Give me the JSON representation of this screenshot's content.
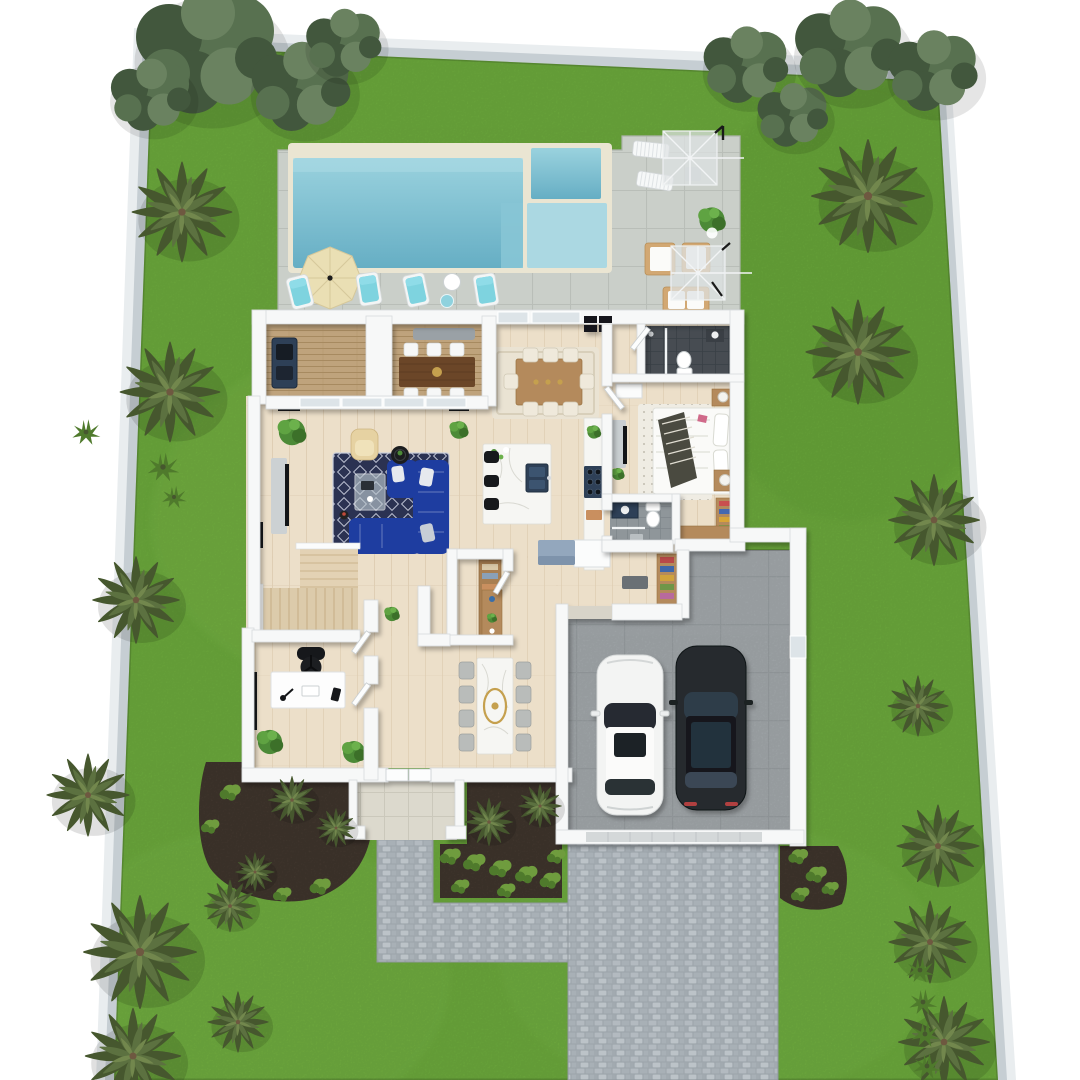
{
  "meta": {
    "title": "3D top-down floor plan rendering of a single-family home lot",
    "view": "aerial orthographic",
    "visible_text": ""
  },
  "colors": {
    "bg": "#ffffff",
    "wallBand": "#c6ced3",
    "wallBandLight": "#e9edef",
    "grass": "#6fae3e",
    "grassLight": "#80bd4e",
    "grassDark": "#5a9931",
    "mulch": "#4a3e34",
    "hedge": "#6f9c3e",
    "hedgeDark": "#4f7a2c",
    "palm": "#5c7140",
    "palmLight": "#72874d",
    "palmDark": "#46572e",
    "palmTrunk": "#6e5840",
    "tree": "#587150",
    "treeDark": "#42573d",
    "treeLight": "#6a8260",
    "patio": "#cacfc9",
    "patioLine": "#b7bcb6",
    "poolCoping": "#eae5d2",
    "poolTop": "#9ad2de",
    "poolDeep": "#66aec4",
    "poolLedge": "#abd8e2",
    "poolStep": "#87c5d5",
    "umbrella": "#eadfb4",
    "umbrellaLine": "#d6c89a",
    "cushionBlue": "#7ed3df",
    "furnTan": "#d2a873",
    "houseWall": "#f7f8f8",
    "wallStroke": "#d6dadc",
    "floorWood": "#ecdfc9",
    "floorLine": "#ddcdb2",
    "deckWood": "#bfa37c",
    "deckLine": "#a78a60",
    "windowGlass": "#dde4e8",
    "doorLeaf": "#fcfdfd",
    "rugNavy": "#2b3252",
    "rugNavyPat": "#c9cedd",
    "rugCream": "#eae3d3",
    "rugCreamLine": "#d8cfba",
    "rugBed": "#efece3",
    "rugBedDot": "#b3ada0",
    "sofa": "#1e3da0",
    "pillow": "#e6e9ee",
    "armchair": "#e6d2a2",
    "coffeeGlass": "#b9c6cc",
    "tvBlack": "#121417",
    "consoleGray": "#ccd1d3",
    "woodFurn": "#b48a5c",
    "woodDark": "#6b4628",
    "shelfWood": "#a97f52",
    "marble": "#f6f6f3",
    "marbleVein": "#d9d9d2",
    "gold": "#c5a04e",
    "stool": "#17191c",
    "navyFixture": "#2e4057",
    "cabinetBlue": "#93a7bd",
    "cabinetBlueDark": "#7e93ab",
    "tileDark": "#474c52",
    "tileDarkLine": "#394046",
    "tileGray": "#8f969a",
    "tileGrayLine": "#7f868b",
    "garage": "#a6acaf",
    "garageDoor": "#d4d8d9",
    "cobbleBase": "#9fa7ad",
    "cobbleA": "#b3bac0",
    "cobbleB": "#a8b0b6",
    "cobbleC": "#bcc3c8",
    "cobbleD": "#a2aab0",
    "porch": "#dcd9cd",
    "porchLine": "#cbc8bb",
    "carWhite": "#f3f4f3",
    "carGlass": "#262c33",
    "carBlack": "#25292e",
    "carBlackRoof": "#2e3c4a",
    "tailRed": "#b04040",
    "benchGray": "#9aa1a6"
  },
  "scene": {
    "rooms": {
      "yard": "Lawn",
      "pool": "Swimming pool",
      "spa": "Spa",
      "ledge": "Tanning ledge",
      "patio": "Pool patio",
      "deck": "Covered deck with outdoor dining",
      "living": "Living room",
      "dining": "Dining area",
      "kitchen": "Kitchen",
      "pantry": "Pantry",
      "bath1": "Bathroom",
      "bedroom": "Bedroom",
      "bath2": "Bathroom",
      "closet": "Closet",
      "mudroom": "Mudroom",
      "office": "Home office",
      "stairs": "Staircase",
      "formal_dining": "Formal dining room",
      "entry": "Entry",
      "porch": "Front porch",
      "garage": "Two-car garage",
      "driveway": "Paver driveway",
      "walkway": "Front walkway"
    },
    "garage_cars": [
      {
        "color": "white"
      },
      {
        "color": "black"
      }
    ],
    "vegetation": [
      {
        "t": "tree",
        "x": 205,
        "y": 52,
        "s": 1.5
      },
      {
        "t": "tree",
        "x": 300,
        "y": 88,
        "s": 1.05
      },
      {
        "t": "tree",
        "x": 150,
        "y": 96,
        "s": 0.85
      },
      {
        "t": "tree",
        "x": 343,
        "y": 44,
        "s": 0.8
      },
      {
        "t": "tree",
        "x": 745,
        "y": 66,
        "s": 0.9
      },
      {
        "t": "tree",
        "x": 792,
        "y": 116,
        "s": 0.75
      },
      {
        "t": "tree",
        "x": 848,
        "y": 50,
        "s": 1.15
      },
      {
        "t": "tree",
        "x": 932,
        "y": 72,
        "s": 0.95
      },
      {
        "t": "palm",
        "x": 182,
        "y": 212,
        "s": 1.15
      },
      {
        "t": "palm",
        "x": 170,
        "y": 392,
        "s": 1.15
      },
      {
        "t": "palm",
        "x": 136,
        "y": 600,
        "s": 1.0
      },
      {
        "t": "palm",
        "x": 88,
        "y": 795,
        "s": 0.95
      },
      {
        "t": "palm",
        "x": 140,
        "y": 952,
        "s": 1.3
      },
      {
        "t": "palm",
        "x": 133,
        "y": 1056,
        "s": 1.1
      },
      {
        "t": "palm",
        "x": 230,
        "y": 906,
        "s": 0.6
      },
      {
        "t": "palm",
        "x": 238,
        "y": 1022,
        "s": 0.7
      },
      {
        "t": "palm",
        "x": 255,
        "y": 872,
        "s": 0.45
      },
      {
        "t": "palm",
        "x": 868,
        "y": 196,
        "s": 1.3
      },
      {
        "t": "palm",
        "x": 858,
        "y": 352,
        "s": 1.2
      },
      {
        "t": "palm",
        "x": 934,
        "y": 520,
        "s": 1.05
      },
      {
        "t": "palm",
        "x": 918,
        "y": 706,
        "s": 0.7
      },
      {
        "t": "palm",
        "x": 938,
        "y": 846,
        "s": 0.95
      },
      {
        "t": "palm",
        "x": 930,
        "y": 942,
        "s": 0.95
      },
      {
        "t": "palm",
        "x": 944,
        "y": 1042,
        "s": 1.05
      },
      {
        "t": "palm",
        "x": 292,
        "y": 800,
        "s": 0.55
      },
      {
        "t": "palm",
        "x": 336,
        "y": 828,
        "s": 0.45
      },
      {
        "t": "palm",
        "x": 489,
        "y": 822,
        "s": 0.55
      },
      {
        "t": "palm",
        "x": 540,
        "y": 806,
        "s": 0.5
      },
      {
        "t": "tuft",
        "x": 163,
        "y": 467,
        "s": 0.9
      },
      {
        "t": "tuft",
        "x": 174,
        "y": 497,
        "s": 0.7
      },
      {
        "t": "tuft",
        "x": 86,
        "y": 432,
        "s": 0.8
      },
      {
        "t": "bush",
        "x": 230,
        "y": 792,
        "s": 0.8
      },
      {
        "t": "bush",
        "x": 210,
        "y": 826,
        "s": 0.7
      },
      {
        "t": "bush",
        "x": 320,
        "y": 886,
        "s": 0.8
      },
      {
        "t": "bush",
        "x": 282,
        "y": 894,
        "s": 0.7
      },
      {
        "t": "bush",
        "x": 450,
        "y": 856,
        "s": 0.8
      },
      {
        "t": "bush",
        "x": 474,
        "y": 862,
        "s": 0.85
      },
      {
        "t": "bush",
        "x": 500,
        "y": 868,
        "s": 0.85
      },
      {
        "t": "bush",
        "x": 526,
        "y": 874,
        "s": 0.85
      },
      {
        "t": "bush",
        "x": 550,
        "y": 880,
        "s": 0.8
      },
      {
        "t": "bush",
        "x": 556,
        "y": 856,
        "s": 0.7
      },
      {
        "t": "bush",
        "x": 460,
        "y": 886,
        "s": 0.7
      },
      {
        "t": "bush",
        "x": 506,
        "y": 890,
        "s": 0.7
      },
      {
        "t": "bush",
        "x": 798,
        "y": 856,
        "s": 0.75
      },
      {
        "t": "bush",
        "x": 816,
        "y": 874,
        "s": 0.8
      },
      {
        "t": "bush",
        "x": 800,
        "y": 894,
        "s": 0.7
      },
      {
        "t": "bush",
        "x": 830,
        "y": 888,
        "s": 0.65
      },
      {
        "t": "tuft",
        "x": 920,
        "y": 970,
        "s": 0.8
      },
      {
        "t": "tuft",
        "x": 923,
        "y": 1002,
        "s": 0.8
      },
      {
        "t": "tuft",
        "x": 925,
        "y": 1034,
        "s": 0.8
      },
      {
        "t": "tuft",
        "x": 927,
        "y": 1066,
        "s": 0.8
      }
    ]
  }
}
